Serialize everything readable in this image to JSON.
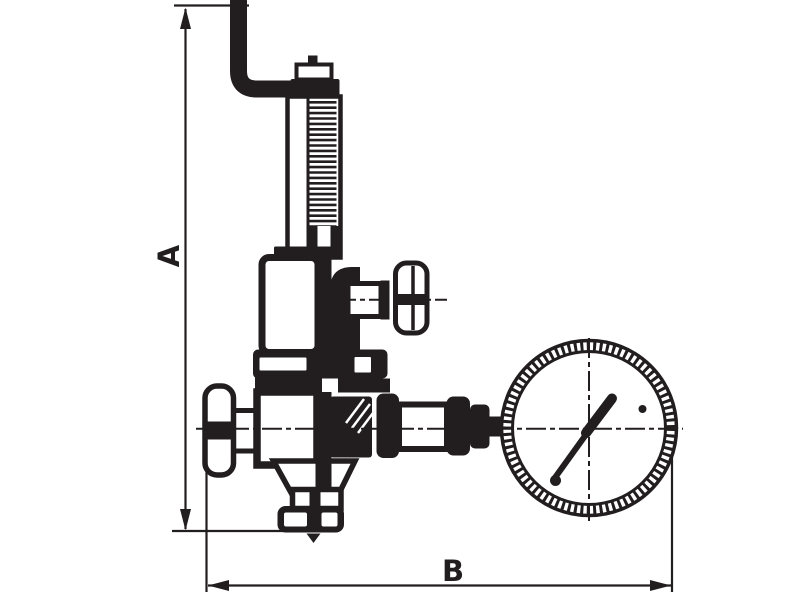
{
  "canvas": {
    "background": "#ffffff",
    "ink": "#221e1f"
  },
  "dimension_labels": {
    "vertical": "A",
    "horizontal": "B"
  },
  "dimensions": [
    {
      "label": "A",
      "orientation": "vertical"
    },
    {
      "label": "B",
      "orientation": "horizontal"
    }
  ],
  "components": [
    "sensing-pipe-elbow",
    "adjusting-screw-cap",
    "spring-housing",
    "threaded-adjuster",
    "bonnet-chamber",
    "side-handwheel",
    "inlet-handwheel",
    "valve-body",
    "connection-pipe",
    "union-nut",
    "bottom-outlet-flange",
    "pressure-gauge",
    "gauge-needle"
  ]
}
